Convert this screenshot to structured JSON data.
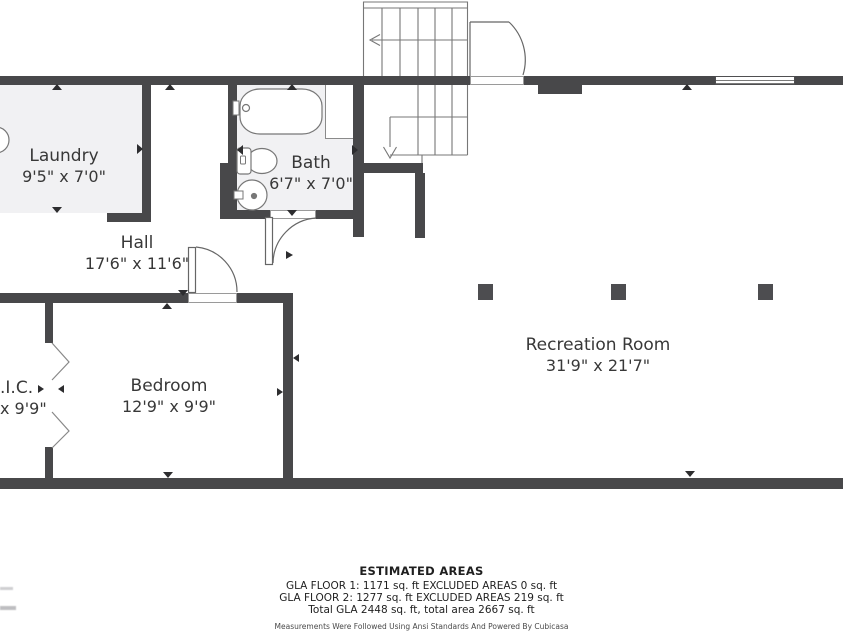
{
  "rooms": [
    {
      "id": "laundry",
      "name": "Laundry",
      "dims": "9'5\" x 7'0\""
    },
    {
      "id": "bath",
      "name": "Bath",
      "dims": "6'7\" x 7'0\""
    },
    {
      "id": "hall",
      "name": "Hall",
      "dims": "17'6\" x 11'6\""
    },
    {
      "id": "bedroom",
      "name": "Bedroom",
      "dims": "12'9\" x 9'9\""
    },
    {
      "id": "wic",
      "name": ".I.C.",
      "dims": "x 9'9\""
    },
    {
      "id": "recreation",
      "name": "Recreation Room",
      "dims": "31'9\" x 21'7\""
    }
  ],
  "summary": {
    "title": "ESTIMATED AREAS",
    "floor1": "GLA FLOOR 1: 1171 sq. ft EXCLUDED AREAS 0 sq. ft",
    "floor2": "GLA FLOOR 2: 1277 sq. ft EXCLUDED AREAS 219 sq. ft",
    "total": "Total GLA 2448 sq. ft, total area 2667 sq. ft",
    "disclaimer": "Measurements Were Followed Using Ansi Standards And Powered By Cubicasa"
  },
  "colors": {
    "wall": "#48484a",
    "floor": "#f1f1f3",
    "line": "#777777",
    "text": "#383838"
  }
}
